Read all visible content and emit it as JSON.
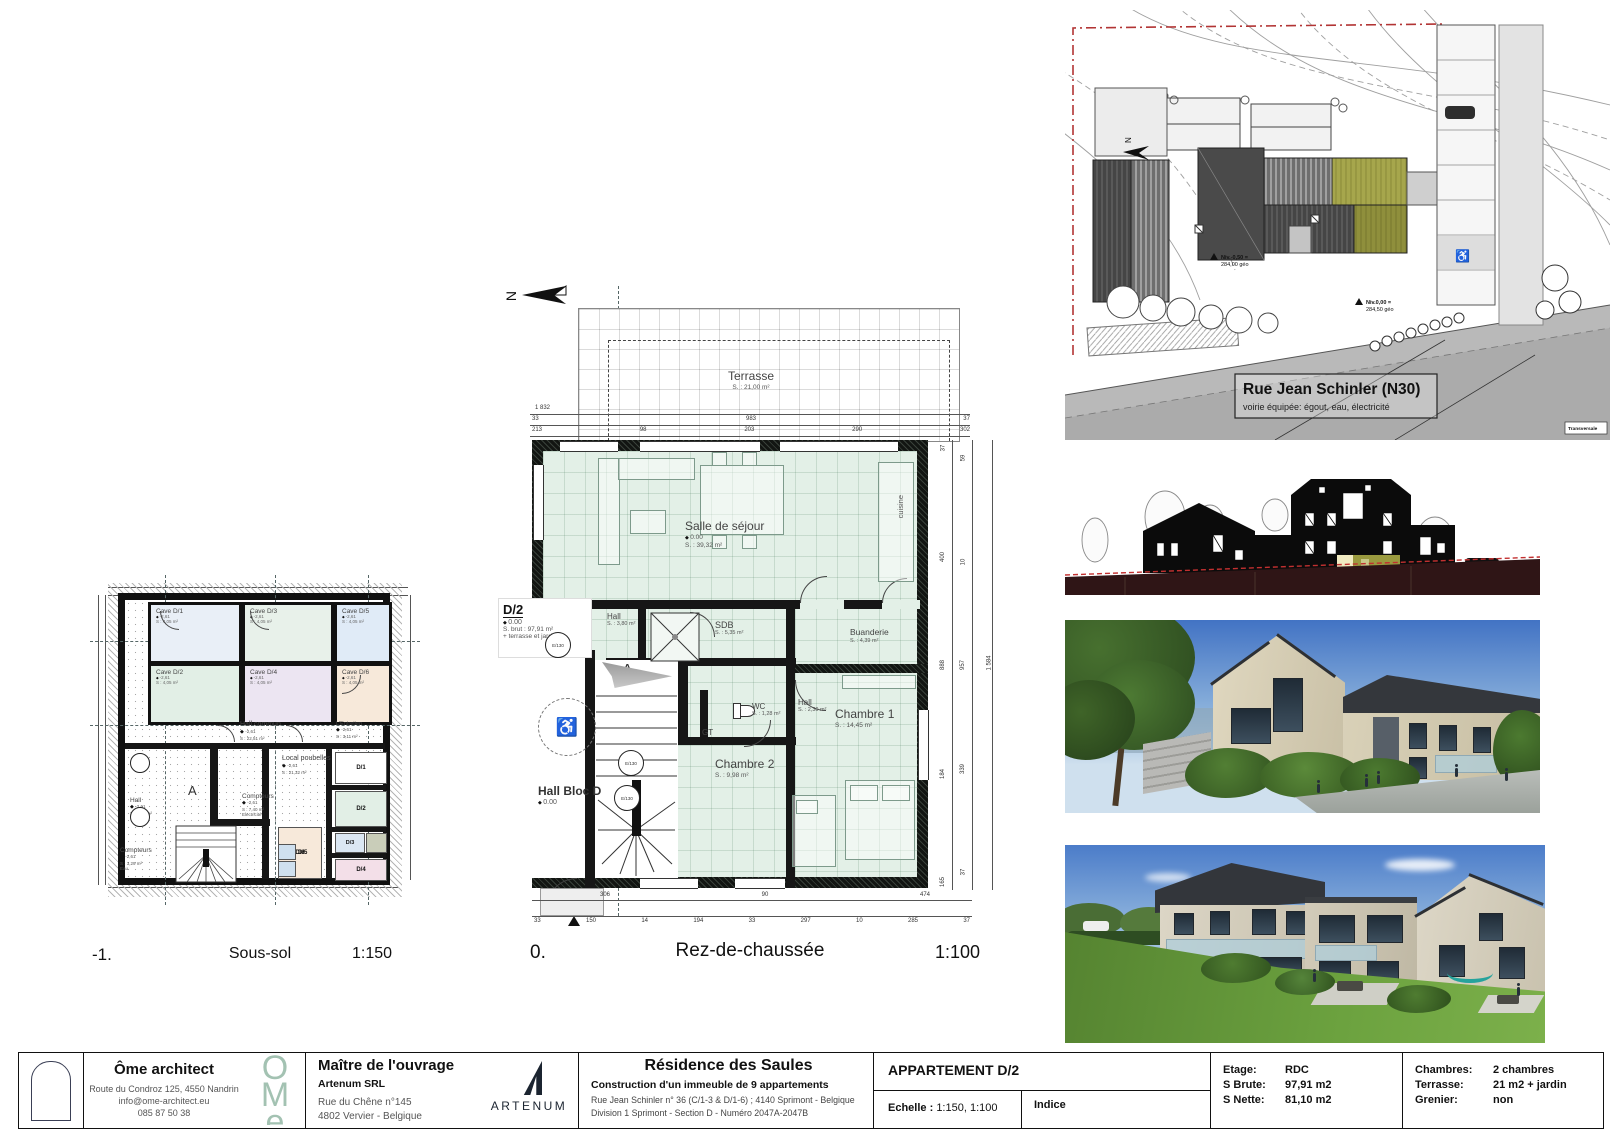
{
  "colors": {
    "accent_olive": "#9a9a45",
    "mint_floor": "#e3f0e7",
    "boundary_red": "#b23434",
    "ome_green": "#a3c2b2"
  },
  "icons": {
    "wheelchair": "♿"
  },
  "soussol": {
    "id": "-1.",
    "title": "Sous-sol",
    "scale": "1:150",
    "section": "A",
    "caves": [
      {
        "name": "Cave D/1",
        "level": "-2,61",
        "surface": "S : 4,05 m²"
      },
      {
        "name": "Cave D/2",
        "level": "-2,61",
        "surface": "S : 4,05 m²"
      },
      {
        "name": "Cave D/3",
        "level": "-2,61",
        "surface": "S : 4,05 m²"
      },
      {
        "name": "Cave D/4",
        "level": "-2,61",
        "surface": "S : 4,05 m²"
      },
      {
        "name": "Cave D/5",
        "level": "-2,61",
        "surface": "S : 4,05 m²"
      },
      {
        "name": "Cave D/6",
        "level": "-2,61",
        "surface": "S : 4,05 m²"
      }
    ],
    "hall_commun": {
      "name": "Hall commun",
      "level": "-2,61",
      "surface": "S : 22,51 m²"
    },
    "entretien": {
      "name": "L'Entretien",
      "level": "-2,61",
      "surface": "S : 3,11 m²"
    },
    "hall": {
      "name": "Hall",
      "level": "-2,61",
      "surface": "S : 4,41 m²"
    },
    "poubelles": {
      "name": "Local poubelles",
      "level": "-2,61",
      "surface": "S : 21,32 m²"
    },
    "compteurs_eau": {
      "name": "Compteurs",
      "level": "-2,61",
      "surface": "S : 3,29 m²",
      "sub": "Eau"
    },
    "compteurs_elec": {
      "name": "Compteurs",
      "level": "-2,61",
      "surface": "S : 7,40 m²",
      "sub": "Electricité"
    },
    "cells": [
      "D/1",
      "D/2",
      "D/3",
      "D/4",
      "D/5",
      "D/6"
    ]
  },
  "rdc": {
    "id": "0.",
    "title": "Rez-de-chaussée",
    "scale": "1:100",
    "north": "N",
    "section": "A",
    "lift": "E/130",
    "gt": "GT",
    "terrasse": {
      "name": "Terrasse",
      "surface": "S. : 21,00 m²"
    },
    "sejour": {
      "name": "Salle de séjour",
      "level": "0.00",
      "surface": "S. : 39,32 m²"
    },
    "cuisine": "cuisine",
    "unit": {
      "id": "D/2",
      "level": "0.00",
      "brut": "S. brut : 97,91 m²",
      "extra": "+ terrasse et jardin"
    },
    "hall1": {
      "name": "Hall",
      "surface": "S. : 3,80 m²"
    },
    "sdb": {
      "name": "SDB",
      "surface": "S. : 5,35 m²"
    },
    "buanderie": {
      "name": "Buanderie",
      "surface": "S. : 4,39 m²"
    },
    "hall2": {
      "name": "Hall",
      "surface": "S. : 2,30 m²"
    },
    "wc": {
      "name": "WC",
      "surface": "S. : 1,28 m²"
    },
    "chambre1": {
      "name": "Chambre 1",
      "surface": "S. : 14,45 m²"
    },
    "chambre2": {
      "name": "Chambre 2",
      "surface": "S. : 9,98 m²"
    },
    "hall_bloc": {
      "name": "Hall Bloc D",
      "level": "0.00"
    },
    "dims": {
      "top_total": "1 832",
      "top2": [
        "33",
        "983",
        "37"
      ],
      "top3": [
        "213",
        "98",
        "203",
        "290",
        "302"
      ],
      "bottom1": [
        "306",
        "90",
        "474"
      ],
      "bottom2": [
        "33",
        "150",
        "14",
        "194",
        "33",
        "297",
        "10",
        "285",
        "37"
      ],
      "right_a": [
        "37",
        "400",
        "888",
        "184",
        "165"
      ],
      "right_b": [
        "59",
        "10",
        "957",
        "339",
        "37"
      ],
      "right_total": "1 584"
    }
  },
  "siteplan": {
    "north": "N",
    "street": "Rue Jean Schinler (N30)",
    "street_sub": "voirie équipée: égout, eau, électricité",
    "niv1a": "Niv.-0,50 =",
    "niv1b": "284,00 géo",
    "niv2a": "Niv.0,00 =",
    "niv2b": "284,50 géo",
    "corner": "Transversale"
  },
  "titleblock": {
    "architect": {
      "name": "Ôme architect",
      "address": "Route du Condroz 125,  4550 Nandrin",
      "email": "info@ome-architect.eu",
      "phone": "085 87 50 38",
      "logo": "ÔMe"
    },
    "client": {
      "heading": "Maître de l'ouvrage",
      "name": "Artenum SRL",
      "address1": "Rue du Chêne n°145",
      "address2": "4802 Vervier - Belgique",
      "logo": "ARTENUM"
    },
    "project": {
      "title": "Résidence des Saules",
      "subtitle": "Construction d'un immeuble de 9 appartements",
      "line1": "Rue Jean Schinler n° 36 (C/1-3 & D/1-6)  ; 4140 Sprimont - Belgique",
      "line2": "Division 1 Sprimont - Section D - Numéro 2047A-2047B"
    },
    "apartment": {
      "title": "APPARTEMENT D/2",
      "scale_label": "Echelle :",
      "scale_value": "1:150, 1:100",
      "indice_label": "Indice"
    },
    "surfaces": {
      "etage_label": "Etage:",
      "etage": "RDC",
      "brute_label": "S  Brute:",
      "brute": "97,91 m2",
      "nette_label": "S Nette:",
      "nette": "81,10 m2"
    },
    "features": {
      "chambres_label": "Chambres:",
      "chambres": "2 chambres",
      "terrasse_label": "Terrasse:",
      "terrasse": "21 m2 + jardin",
      "grenier_label": "Grenier:",
      "grenier": "non"
    }
  }
}
